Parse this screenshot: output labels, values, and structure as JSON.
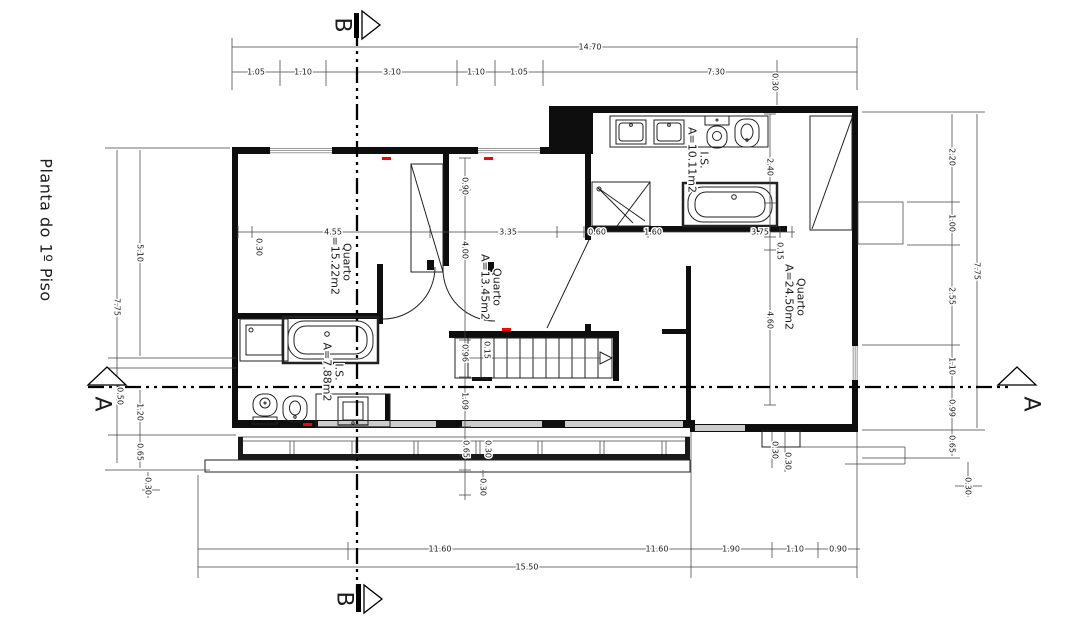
{
  "title": "Planta do 1º Piso",
  "section_markers": {
    "b_top": "B",
    "b_bottom": "B",
    "a_left": "A",
    "a_right": "A"
  },
  "rooms": [
    {
      "name": "Quarto",
      "area": "A=15.22m2"
    },
    {
      "name": "Quarto",
      "area": "A=13.45m2"
    },
    {
      "name": "Quarto",
      "area": "A=24.50m2"
    },
    {
      "name": "I.S.",
      "area": "A=10.11m2"
    },
    {
      "name": "I.S.",
      "area": "A=7.88m2"
    }
  ],
  "dims": {
    "top_total": "14.70",
    "t1": "1.05",
    "t2": "1.10",
    "t3": "3.10",
    "t4": "1.10",
    "t5": "1.05",
    "t6": "7.30",
    "t7": "0.30",
    "l1": "5.10",
    "l2": "7.75",
    "l3": "0.50",
    "l4": "1.20",
    "l5": "0.65",
    "l6": "0.30",
    "r1": "2.20",
    "r2": "1.00",
    "r3": "7.75",
    "r4": "2.55",
    "r5": "1.10",
    "r6": "0.99",
    "r7": "0.65",
    "r8": "0.30",
    "m1": "0.30",
    "m2": "4.55",
    "m3": "3.35",
    "m4": "0.60",
    "m5": "1.60",
    "m6": "3.75",
    "m7": "0.15",
    "c1": "0.90",
    "c2": "4.00",
    "c3": "0.96",
    "c4": "0.15",
    "c5": "1.09",
    "c6": "0.65",
    "c7": "0.30",
    "c8": "0.30",
    "q1": "2.40",
    "q2": "4.60",
    "q3": "0.30",
    "q4": "0.30",
    "b1": "11.60",
    "b2": "11.60",
    "b3": "1.90",
    "b4": "1.10",
    "b5": "0.90",
    "b_total": "15.50"
  },
  "colors": {
    "wall": "#0e0e0e",
    "dimension": "#444444",
    "window": "#999999",
    "mark": "#ff0000",
    "paper": "#ffffff"
  }
}
